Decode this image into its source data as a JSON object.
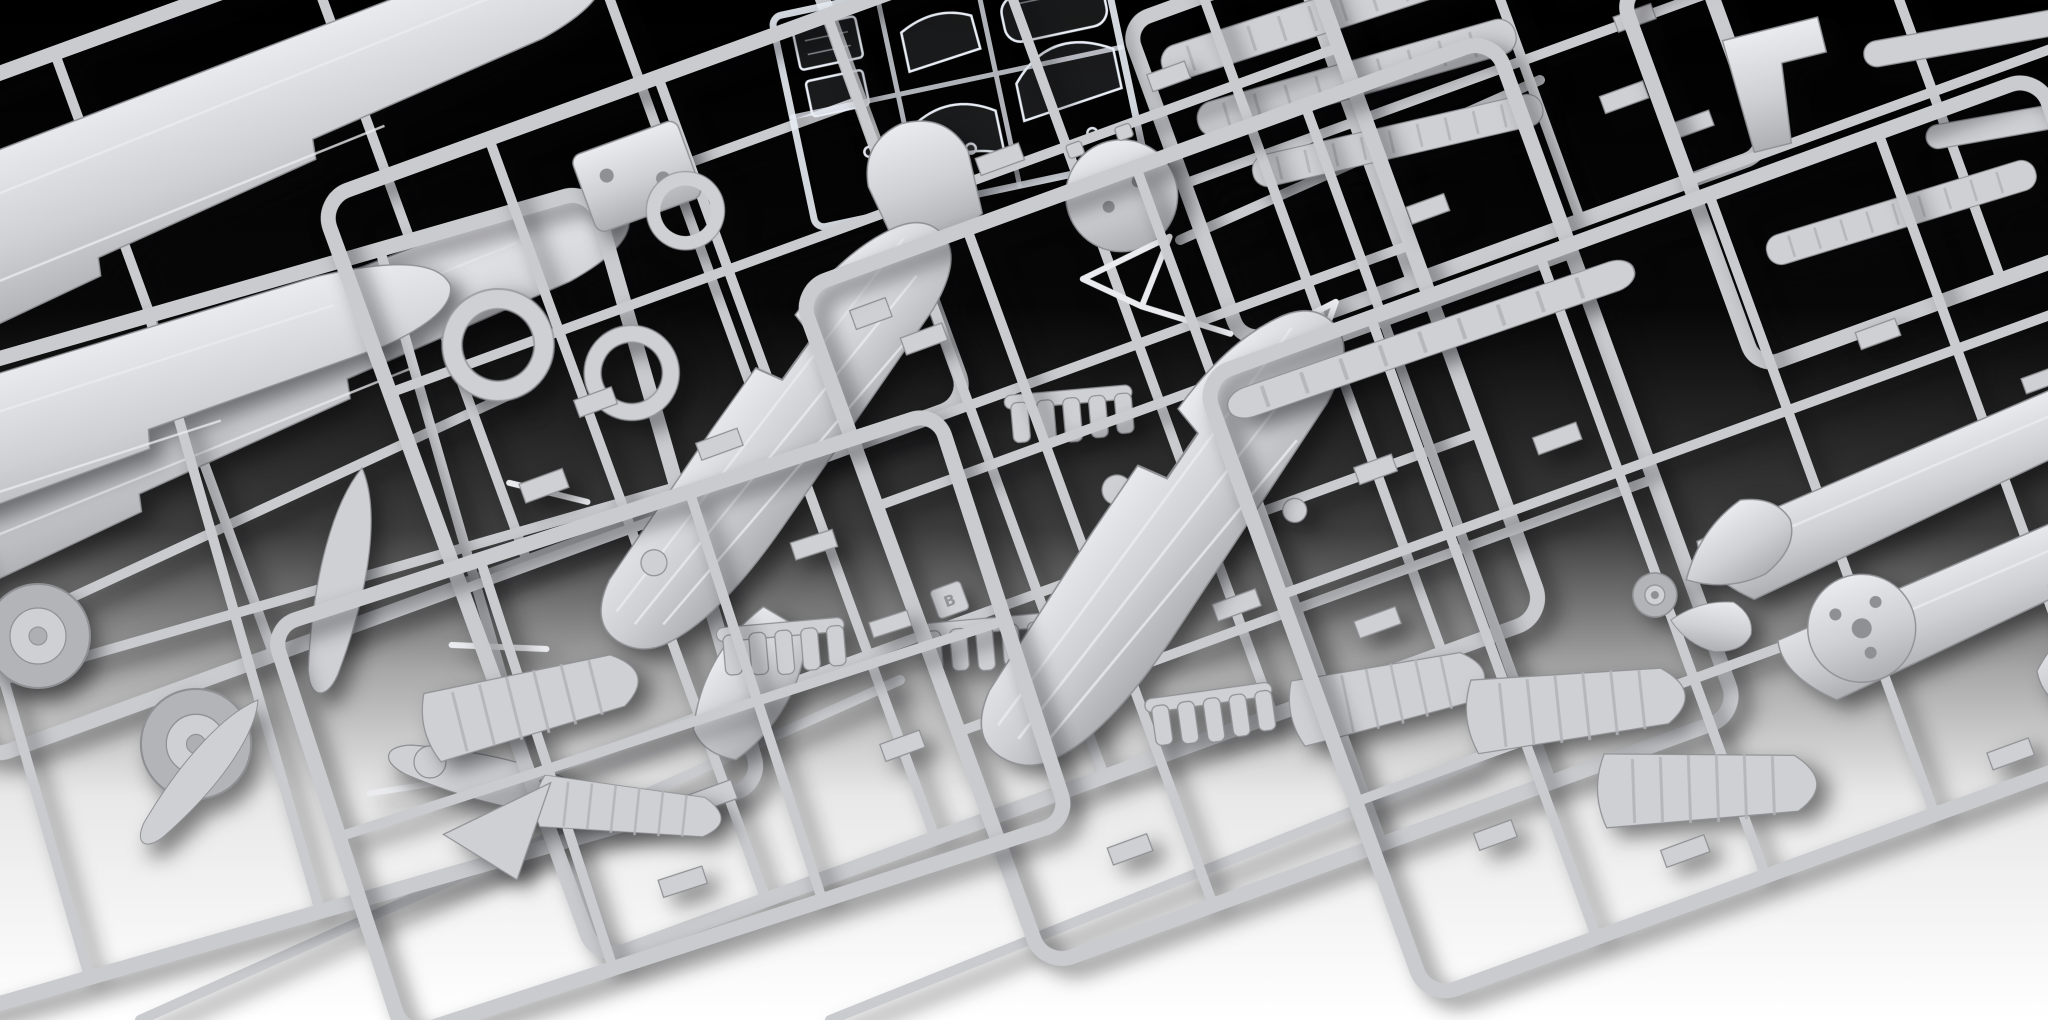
{
  "scene": {
    "type": "photograph",
    "subject": "Unassembled plastic scale-model aircraft kit: grey injection-moulded sprues and one transparent canopy sprue laid out on a studio backdrop fading from black (top) to white (bottom)",
    "background": {
      "top": "#000000",
      "upper": "#070707",
      "mid": "#3d3d3d",
      "lower": "#a9a9a9",
      "base": "#e8e8e8",
      "bottom": "#ffffff"
    },
    "colors": {
      "plastic": "#cfd0d4",
      "plasticLight": "#eaebee",
      "plasticDark": "#aeafb3",
      "plasticDeep": "#8f9094",
      "frame": "#c9cbcf",
      "rib": "#b2b3b7",
      "tire": "#b3b4b8",
      "clearStroke": "#e9eef6",
      "clearFill": "rgba(240,245,252,0.10)",
      "shadow": "rgba(8,8,10,0.5)"
    },
    "sprues": [
      {
        "id": "top-left-wings",
        "name": "upper wing panels sprue",
        "parts": [
          "large tapered wing panel",
          "large tapered wing panel",
          "runner frame",
          "cross runners"
        ]
      },
      {
        "id": "left-undercarriage",
        "name": "lower wing and undercarriage sprue",
        "parts": [
          "lower wing panel",
          "main wheel",
          "main wheel",
          "propeller blade",
          "propeller blade",
          "propeller blade",
          "strut rods"
        ]
      },
      {
        "id": "clear-parts",
        "name": "transparent canopy sprue",
        "material": "clear polystyrene",
        "parts": [
          "windscreen",
          "sliding canopy",
          "rear canopy section",
          "cabin glazing panel",
          "cabin glazing panel",
          "curved canopy section",
          "clear runner frame"
        ]
      },
      {
        "id": "center-main",
        "name": "main fuselage sprue",
        "molded_tag": "B",
        "parts": [
          "fuselage half",
          "engine cowling ring",
          "engine cowling ring",
          "cockpit opening ring",
          "firewall plate",
          "pilot seat",
          "bulkhead disc",
          "nose scoop panel",
          "exhaust stack comb",
          "exhaust stack comb",
          "exhaust stack comb",
          "cabane strut truss",
          "cabane strut truss",
          "small fittings"
        ]
      },
      {
        "id": "center-right-fuselage",
        "name": "second fuselage sprue",
        "parts": [
          "fuselage half",
          "exhaust stack comb",
          "ribbed control surface",
          "small fittings"
        ]
      },
      {
        "id": "top-right-strips",
        "name": "wing rib strip sprue",
        "parts": [
          "ribbed wing strip",
          "ribbed wing strip",
          "ribbed wing strip",
          "small brackets"
        ]
      },
      {
        "id": "far-top-right",
        "name": "cowl panel sprue",
        "parts": [
          "L-shaped cowl panel",
          "narrow fairing strip",
          "narrow fairing strip",
          "ribbed strip",
          "small brackets"
        ]
      },
      {
        "id": "right-main",
        "name": "tail surfaces sprue",
        "parts": [
          "leading-edge strip",
          "large wing skin panel",
          "large wing skin panel",
          "ribbed elevator half",
          "ribbed elevator half",
          "propeller spinner cone",
          "teardrop fairing",
          "firewall disc",
          "tail wheel",
          "tail cone saddle",
          "rear fuselage panel",
          "small fittings"
        ]
      },
      {
        "id": "bottom-center",
        "name": "flap and bracket sprue",
        "parts": [
          "ribbed flap",
          "ribbed flap section",
          "support bracket",
          "small fittings"
        ]
      },
      {
        "id": "runner-lattice",
        "name": "overlapping loose runner bars",
        "parts": [
          "runner bar",
          "runner bar",
          "runner bar",
          "runner bar"
        ]
      }
    ]
  }
}
